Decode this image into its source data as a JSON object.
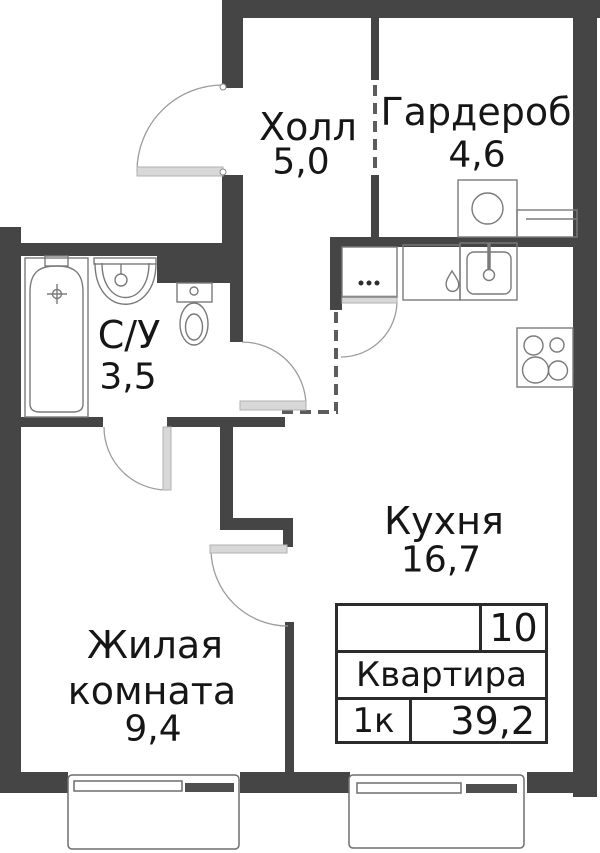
{
  "rooms": {
    "hall": {
      "name": "Холл",
      "area": "5,0"
    },
    "wardrobe": {
      "name": "Гардероб",
      "area": "4,6"
    },
    "bathroom": {
      "name": "С/У",
      "area": "3,5"
    },
    "kitchen": {
      "name": "Кухня",
      "area": "16,7"
    },
    "living": {
      "name_line1": "Жилая",
      "name_line2": "комната",
      "area": "9,4"
    }
  },
  "info_table": {
    "number": "10",
    "label": "Квартира",
    "rooms_count": "1к",
    "total_area": "39,2"
  },
  "fixtures": [
    "bathtub-icon",
    "bath-sink-icon",
    "toilet-icon",
    "washing-machine-icon",
    "kitchen-cabinet-icon",
    "dishwasher-icon",
    "kitchen-sink-icon",
    "stove-icon",
    "window",
    "balcony"
  ],
  "colors": {
    "wall": "#454545",
    "door_leaf": "#d8d8d8",
    "fixture_line": "#7a7a7a",
    "text": "#161616",
    "table_border": "#2b2b2b"
  }
}
